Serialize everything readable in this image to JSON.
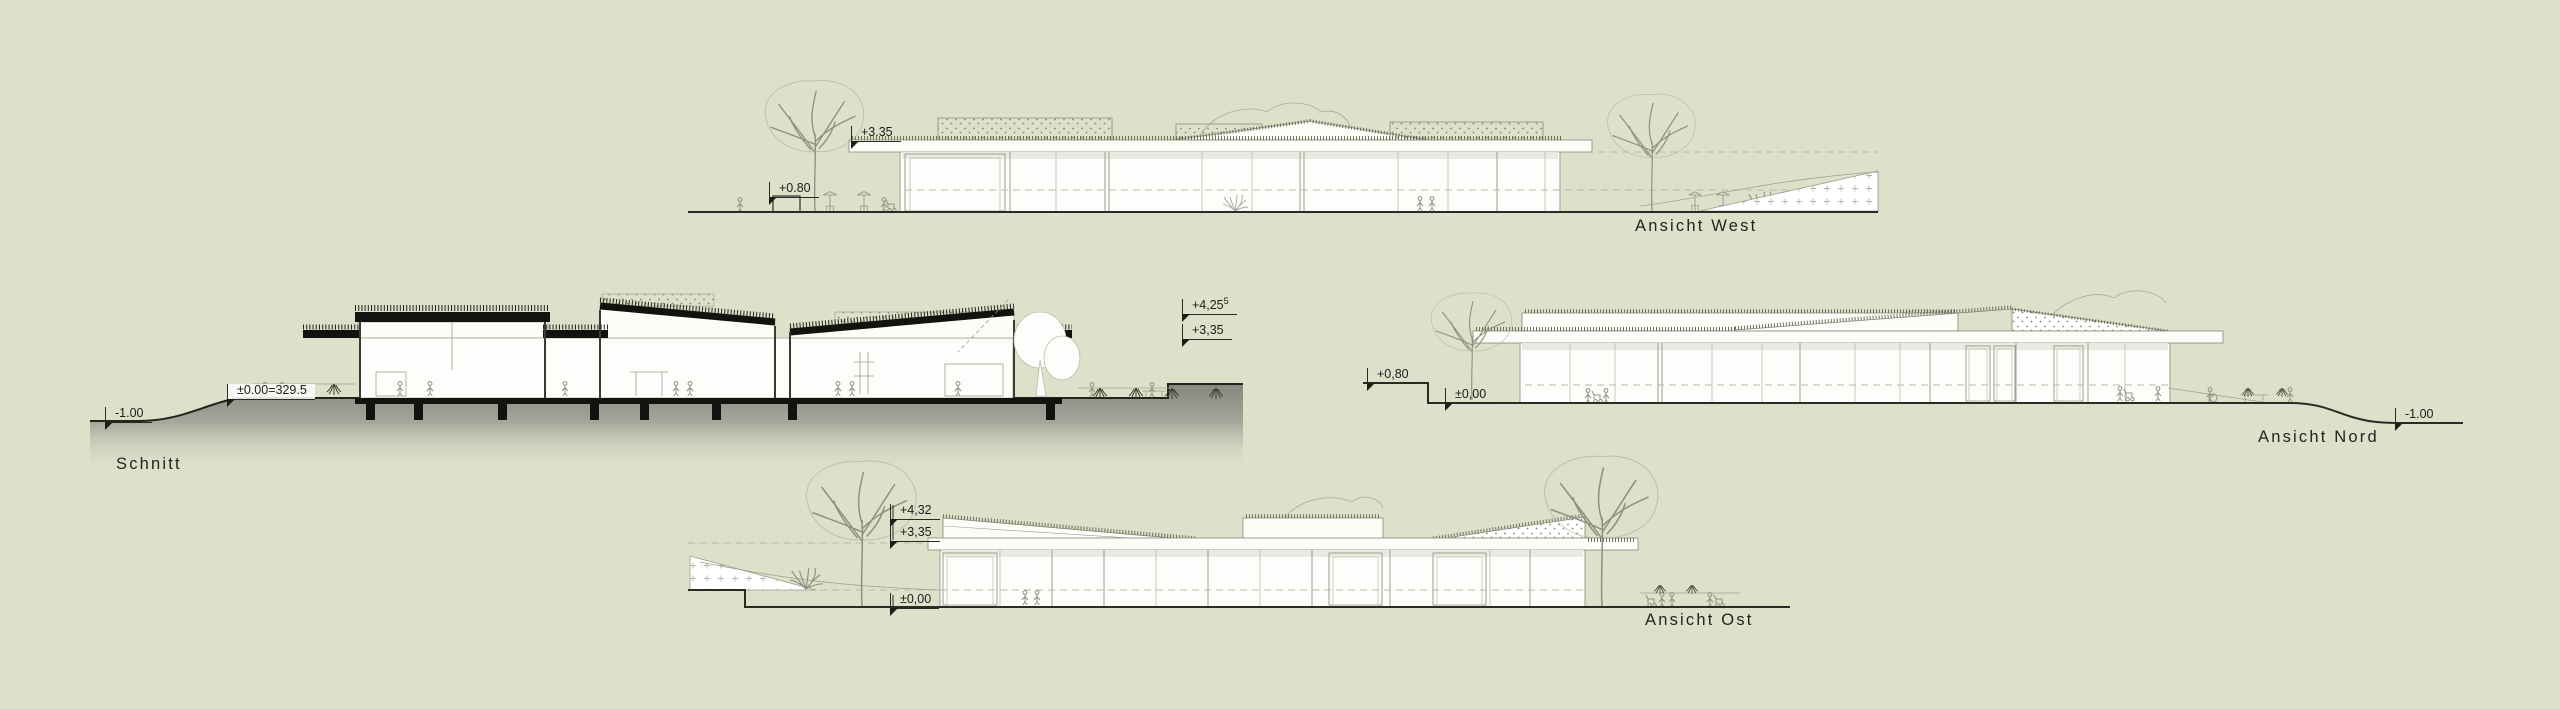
{
  "sheet": {
    "background_color": "#dde1ca",
    "ink_color": "#2b2b26",
    "outline_color": "#85887a",
    "grass_color": "#5d6549",
    "cut_black": "#12120e"
  },
  "titles": {
    "schnitt": "Schnitt",
    "west": "Ansicht West",
    "nord": "Ansicht Nord",
    "ost": "Ansicht Ost"
  },
  "levels": {
    "west_roof": {
      "value": "+3.35",
      "sup": ""
    },
    "west_planter": {
      "value": "+0.80",
      "sup": ""
    },
    "schnitt_minus1": {
      "value": "-1.00",
      "sup": ""
    },
    "schnitt_datum": {
      "value": "±0.00=329.5",
      "sup": ""
    },
    "schnitt_high": {
      "value": "+4,25",
      "sup": "5"
    },
    "schnitt_roof": {
      "value": "+3,35",
      "sup": ""
    },
    "nord_upper": {
      "value": "+0,80",
      "sup": ""
    },
    "nord_zero": {
      "value": "±0,00",
      "sup": ""
    },
    "nord_minus1": {
      "value": "-1.00",
      "sup": ""
    },
    "ost_high": {
      "value": "+4,32",
      "sup": ""
    },
    "ost_roof": {
      "value": "+3,35",
      "sup": ""
    },
    "ost_zero": {
      "value": "±0,00",
      "sup": ""
    }
  }
}
